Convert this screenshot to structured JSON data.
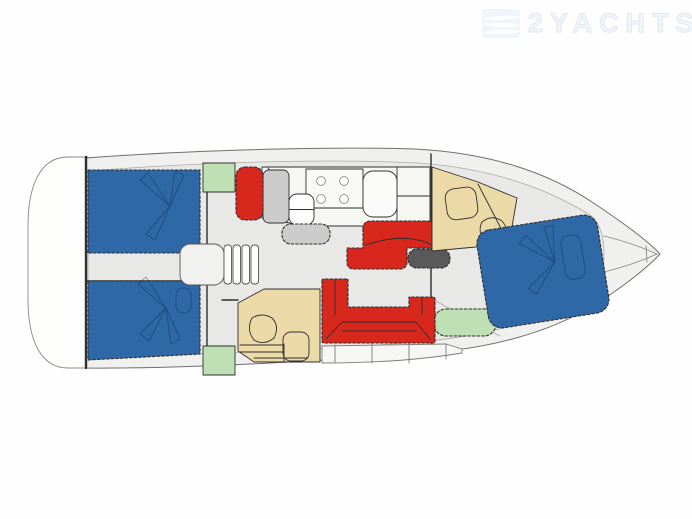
{
  "watermark": {
    "text": "2YACHTS",
    "logo": "waves-logo-icon"
  },
  "colors": {
    "background": "#fffefe",
    "deck": "#f0f1ee",
    "floor": "#e8e9e6",
    "platform": "#fdfdfc",
    "bed_blue": "#2e68a6",
    "sofa_red": "#d8271c",
    "accent_green": "#bfe0b4",
    "wood_tan": "#ecd9a8",
    "counter_gray": "#cccccc",
    "counter_white": "#f6f6f3",
    "dark_gray": "#595959",
    "outline": "#2f2f2f",
    "hull_stroke": "#6f6f6f",
    "watermark_blue": "#c1d4e7"
  },
  "plan": {
    "type": "sailing-yacht-deck-plan",
    "areas": [
      "swim-platform",
      "aft-cabin-port",
      "aft-cabin-starboard",
      "companionway-steps",
      "galley",
      "salon-chaise-settee",
      "dinette-u-settee",
      "nav-seat",
      "aft-head",
      "forward-head",
      "forward-cabin",
      "bow-anchor-locker"
    ]
  }
}
